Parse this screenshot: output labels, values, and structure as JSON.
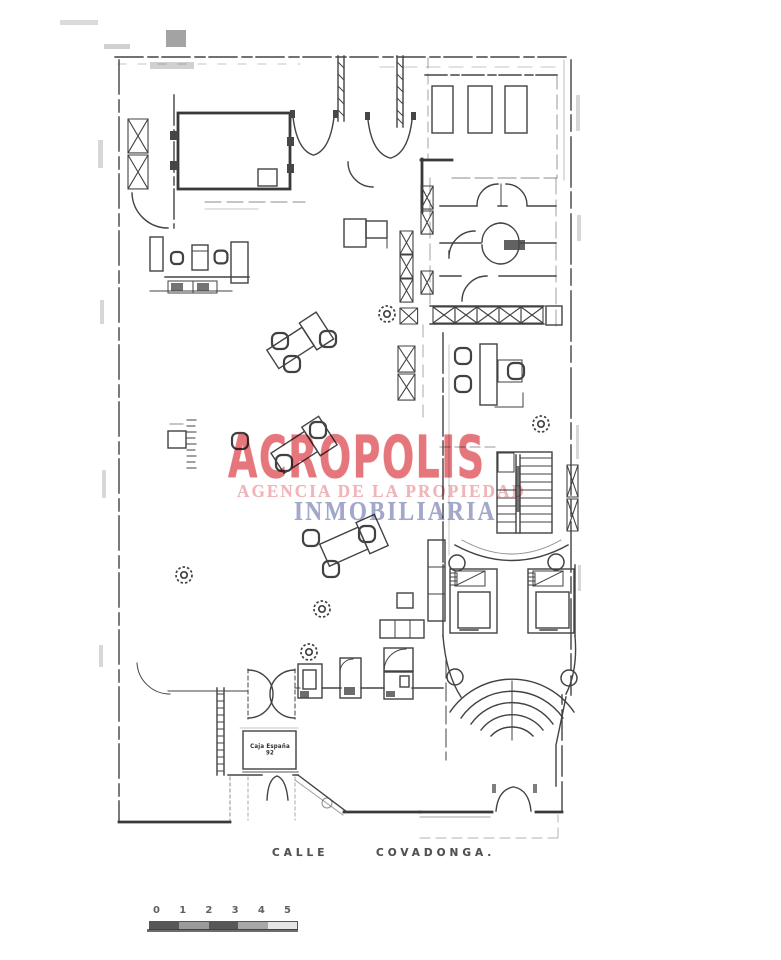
{
  "watermark": {
    "brand": "ACROPOLIS",
    "line2": "AGENCIA DE LA PROPIEDAD",
    "line3": "INMOBILIARIA",
    "colors": {
      "brand": "#e2636a",
      "line2": "#eda8ad",
      "line3": "#999fc6"
    }
  },
  "street_labels": {
    "calle": "CALLE",
    "name": "COVADONGA."
  },
  "scale_bar": {
    "ticks": [
      "0",
      "1",
      "2",
      "3",
      "4",
      "5"
    ]
  },
  "entrance_mat": {
    "label": "Caja España 92"
  },
  "colors": {
    "ink": "#2e2e2e",
    "paper": "#ffffff"
  }
}
